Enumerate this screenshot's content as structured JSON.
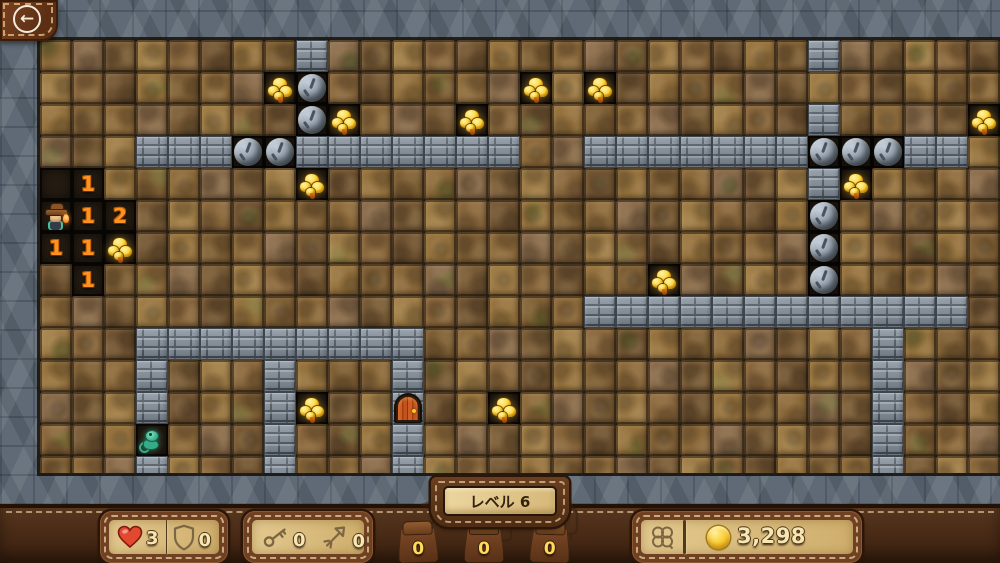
{
  "back_button": {
    "icon": "back-arrow-icon",
    "glyph": "←"
  },
  "level_badge": {
    "label": "レベル 6"
  },
  "hud": {
    "health": {
      "icon": "heart-icon",
      "value": "3"
    },
    "shield": {
      "icon": "shield-icon",
      "value": "0"
    },
    "keys": {
      "icon": "key-icon",
      "value": "0"
    },
    "arrows": {
      "icon": "arrow-icon",
      "value": "0"
    },
    "pouches": [
      {
        "tool": "pickaxe-icon",
        "value": "0"
      },
      {
        "tool": "flask-icon",
        "value": "0"
      },
      {
        "tool": "lantern-icon",
        "value": "0"
      }
    ],
    "luck": {
      "icon": "clover-icon"
    },
    "coins": {
      "icon": "coin-icon",
      "value": "3,298"
    }
  },
  "board": {
    "cols": 30,
    "rows": 14,
    "tile_size": 32,
    "legend": {
      "D": "dirt",
      "K": "excavated",
      "B": "brick-wall",
      "O": "boulder",
      "G": "gold",
      "1": "number-1",
      "2": "number-2",
      "M": "miner",
      "C": "creature",
      "R": "door"
    },
    "tiles": [
      "DDDDDDDDBDDDDDDDDDDDDDDDBDDDDD",
      "DDDDDDDGODDDDDDGDGDDDDDDDDDDDD",
      "DDDDDDDDOGDDDGDDDDDDDDDDBDDDDG",
      "DDDBBBOOBBBBBBBDDBBBBBBBOOOBBD",
      "K1DDDDDDGDDDDDDDDDDDDDDDBGDDDD",
      "M12DDDDDDDDDDDDDDDDDDDDDODDDDD",
      "11GDDDDDDDDDDDDDDDDDDDDDODDDDD",
      "D1DDDDDDDDDDDDDDDDDGDDDDODDDDD",
      "DDDDDDDDDDDDDDDDDBBBBBBBBBBBBD",
      "DDDBBBBBBBBBDDDDDDDDDDDDDDBDDD",
      "DDDBDDDBDDDBDDDDDDDDDDDDDDBDDD",
      "DDDBDDDBGDDRDDGDDDDDDDDDDDBDDD",
      "DDDCDDDBDDDBDDDDDDDDDDDDDDBDDD",
      "DDDBDDDBDDDBDDDDDDDDDDDDDDBDDD"
    ]
  },
  "colors": {
    "accent_gold": "#f7c922",
    "number_orange": "#ff9320",
    "leather": "#4a2c17",
    "parchment": "#dcc186",
    "stone": "#5f6a76",
    "brick": "#7f8b97",
    "heart_red": "#e2492f",
    "dirt_shades": [
      "#8a683a",
      "#7b5c33",
      "#94713d",
      "#6d5130",
      "#87653b",
      "#9c7a45",
      "#755834",
      "#856848"
    ]
  }
}
